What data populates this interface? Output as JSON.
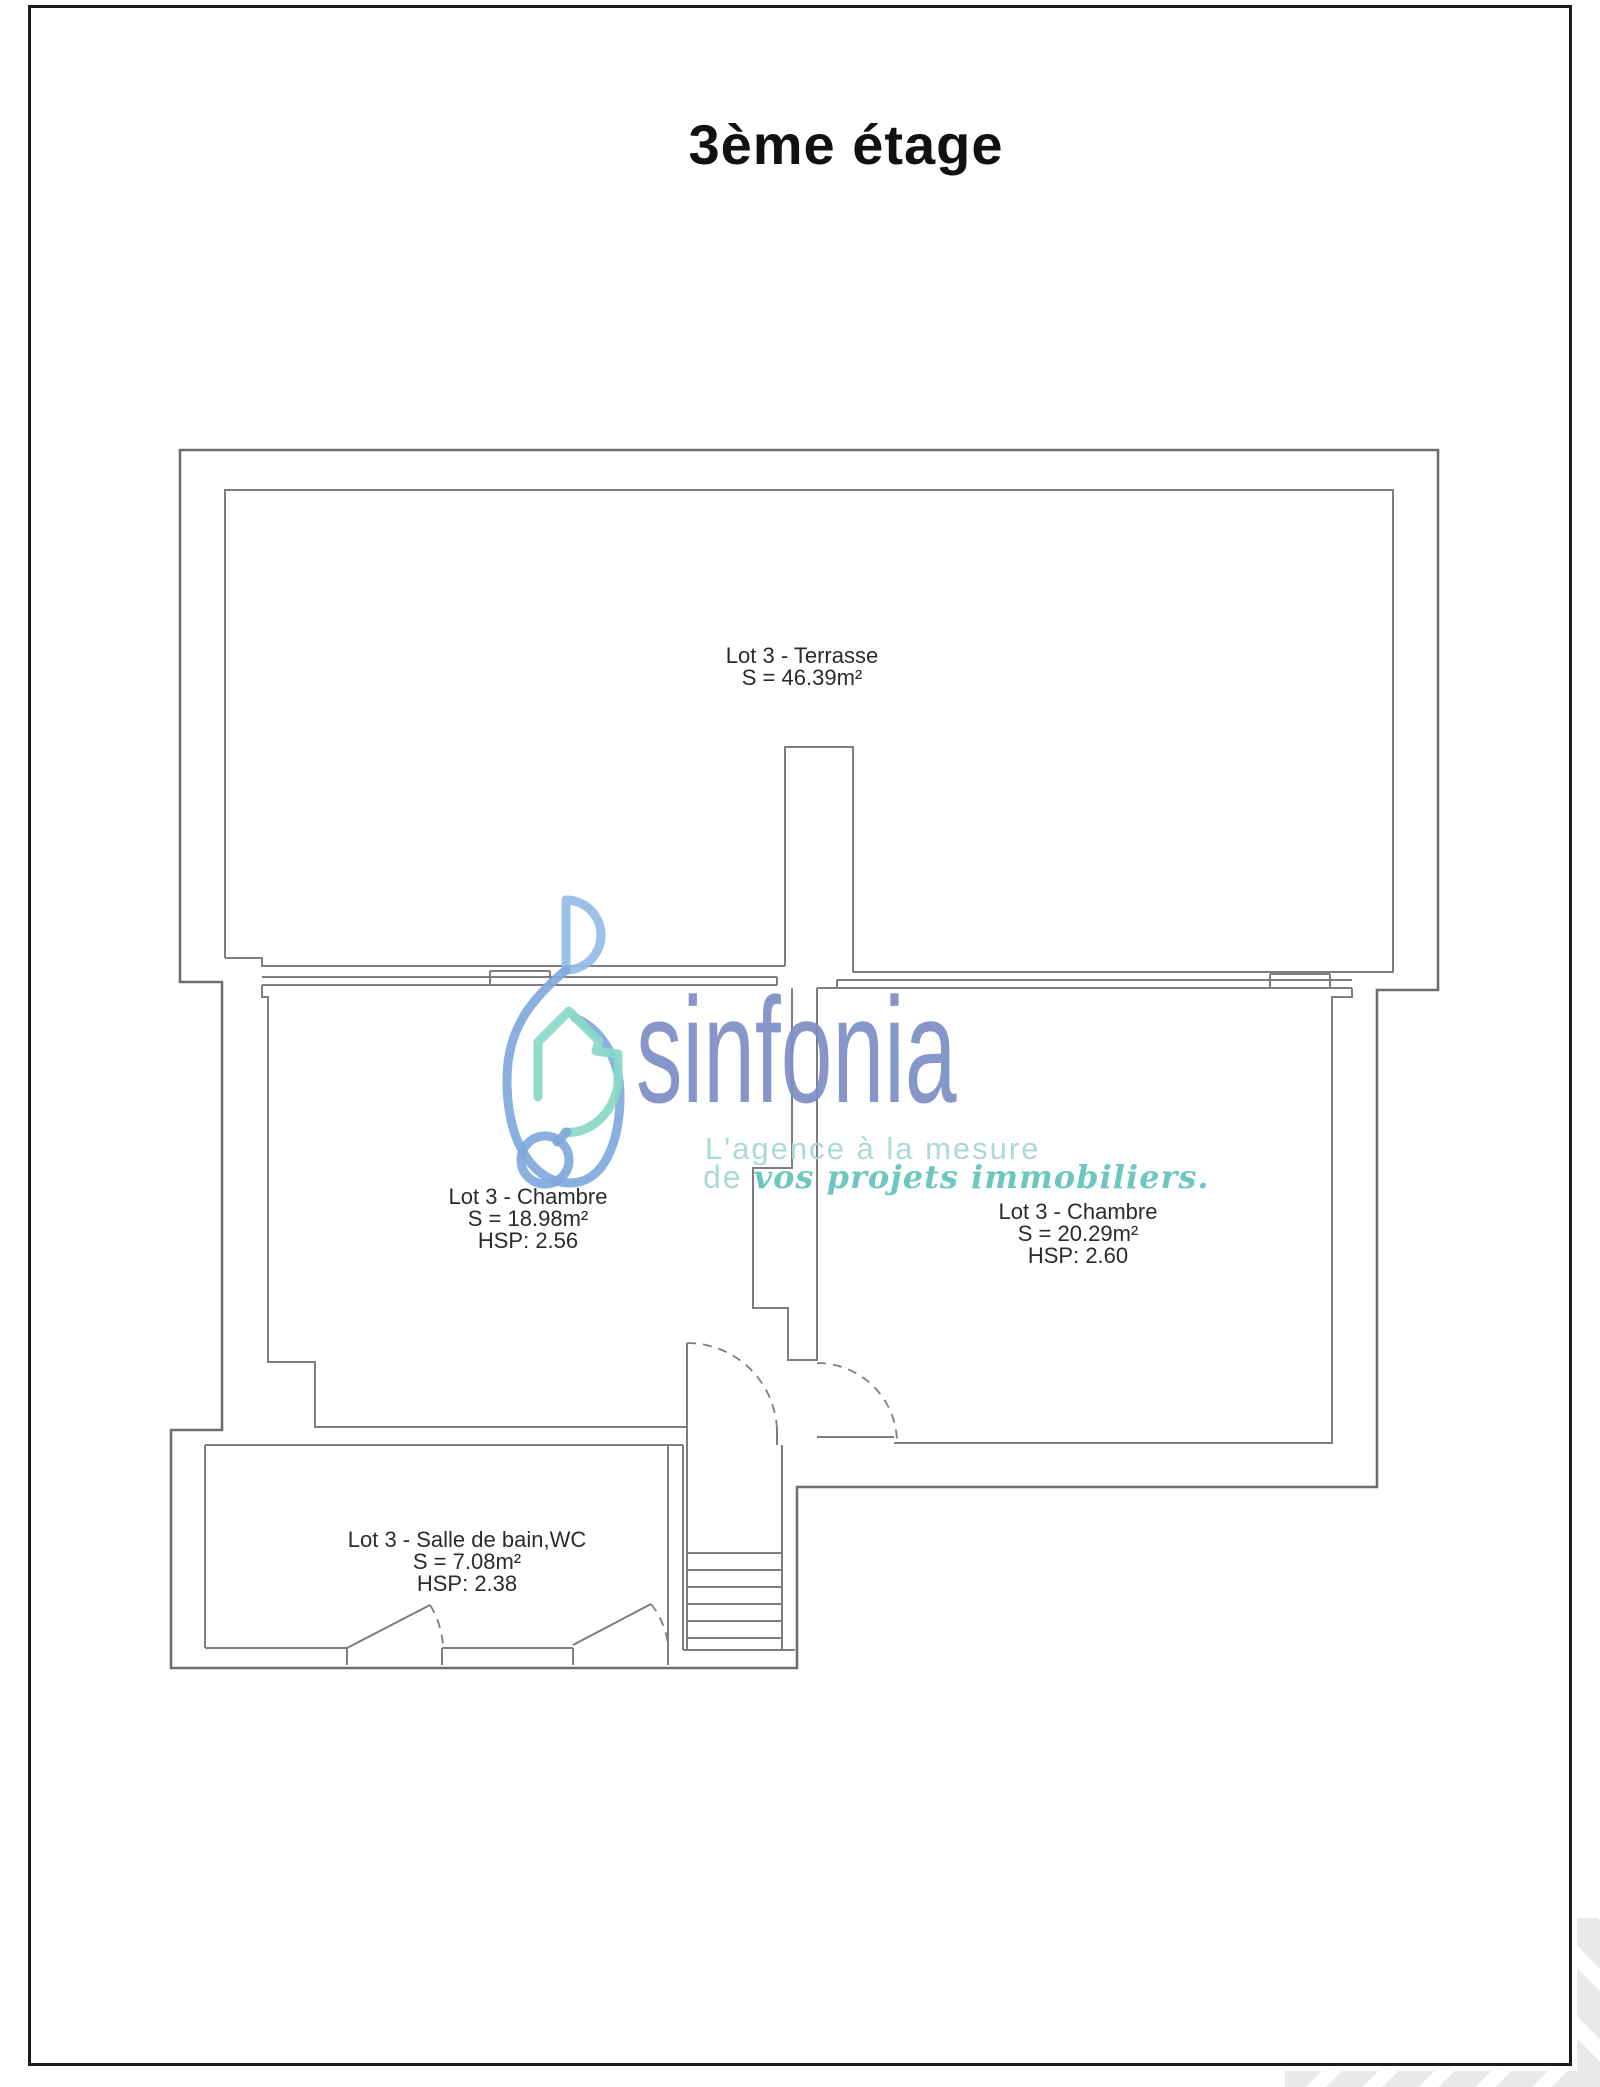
{
  "page": {
    "title": "3ème étage"
  },
  "colors": {
    "frame": "#1c1c1c",
    "plan-line": "#7e7e7e",
    "label-text": "#2b2b2b",
    "brand": "#7d8ec5",
    "tagline-light": "#a9d8d3",
    "tagline-script": "#67c5bb",
    "logo-blue-light": "#93bce7",
    "logo-blue": "#7fa9dc",
    "logo-teal": "#89d8c5",
    "chevron": "#e9e9e9"
  },
  "rooms": {
    "terrasse": {
      "label": "Lot 3 - Terrasse",
      "area": "S = 46.39m²"
    },
    "chambre_left": {
      "label": "Lot 3 - Chambre",
      "area": "S = 18.98m²",
      "hsp": "HSP: 2.56"
    },
    "chambre_right": {
      "label": "Lot 3 - Chambre",
      "area": "S = 20.29m²",
      "hsp": "HSP: 2.60"
    },
    "salle_de_bain": {
      "label": "Lot 3 - Salle de bain,WC",
      "area": "S = 7.08m²",
      "hsp": "HSP: 2.38"
    }
  },
  "watermark": {
    "brand": "sinfonia",
    "tagline_line1": "L'agence à la mesure",
    "tagline_de": "de ",
    "tagline_script": "vos projets immobiliers."
  }
}
